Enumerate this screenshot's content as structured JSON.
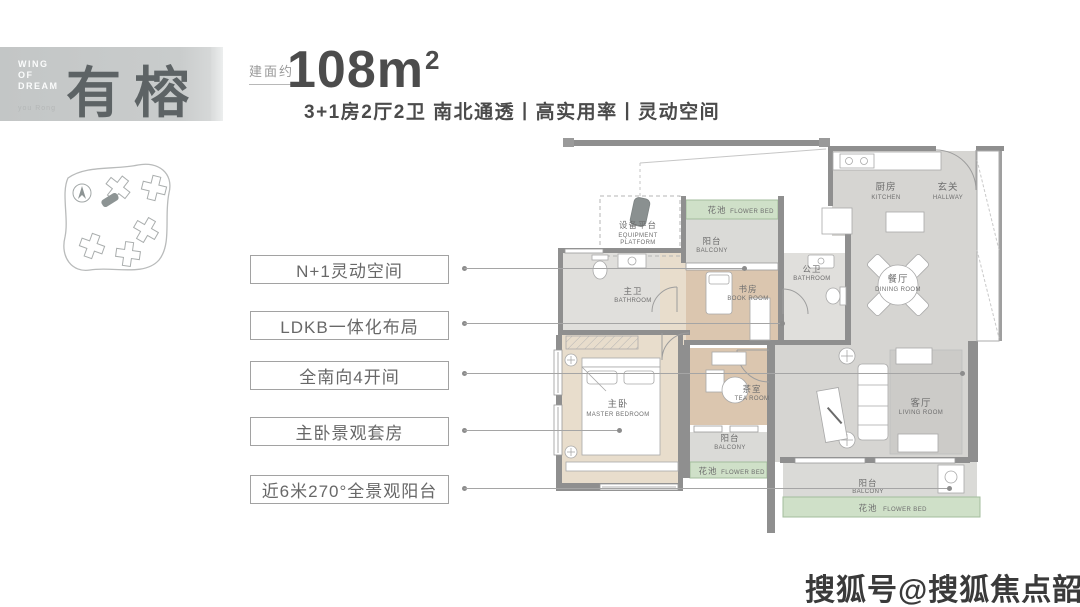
{
  "banner": {
    "line1": "WING",
    "line2": "OF",
    "line3": "DREAM",
    "pinyin": "you Rong",
    "name": "有榕"
  },
  "header": {
    "area_label": "建面约",
    "area_value": "108m",
    "area_sup": "2",
    "tagline": "3+1房2厅2卫 南北通透丨高实用率丨灵动空间"
  },
  "features": [
    {
      "label": "N+1灵动空间"
    },
    {
      "label": "LDKB一体化布局"
    },
    {
      "label": "全南向4开间"
    },
    {
      "label": "主卧景观套房"
    },
    {
      "label": "近6米270°全景观阳台"
    }
  ],
  "floorplan": {
    "rooms": {
      "kitchen": {
        "cn": "厨房",
        "en": "KITCHEN"
      },
      "hallway": {
        "cn": "玄关",
        "en": "HALLWAY"
      },
      "flower_bed": {
        "cn": "花池",
        "en": "FLOWER BED"
      },
      "equipment": {
        "cn": "设备平台",
        "en1": "EQUIPMENT",
        "en2": "PLATFORM"
      },
      "balcony": {
        "cn": "阳台",
        "en": "BALCONY"
      },
      "master_bath": {
        "cn": "主卫",
        "en": "BATHROOM"
      },
      "book_room": {
        "cn": "书房",
        "en": "BOOK ROOM"
      },
      "public_bath": {
        "cn": "公卫",
        "en": "BATHROOM"
      },
      "dining": {
        "cn": "餐厅",
        "en": "DINING ROOM"
      },
      "master_bedroom": {
        "cn": "主卧",
        "en": "MASTER BEDROOM"
      },
      "tea_room": {
        "cn": "茶室",
        "en": "TEA ROOM"
      },
      "living": {
        "cn": "客厅",
        "en": "LIVING ROOM"
      }
    }
  },
  "watermark": "搜狐号@搜狐焦点韶关站",
  "colors": {
    "flower_green": "#cfe0c8",
    "wall_gray": "#8f8f8f",
    "floor_gray": "#d6d5d2",
    "wood": "#e8ddcc",
    "tan": "#dbc6af"
  }
}
